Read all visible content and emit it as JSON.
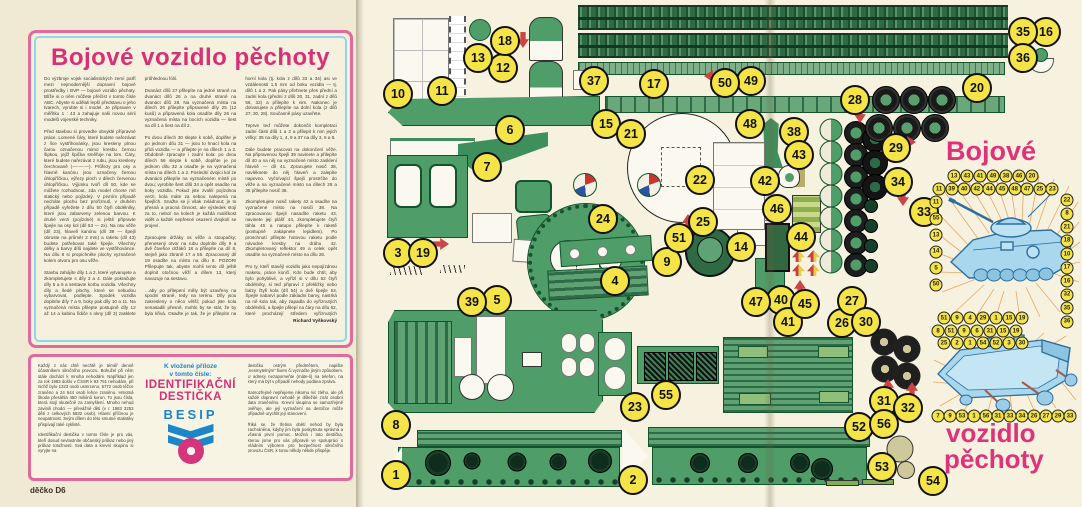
{
  "magazine": {
    "left_page": {
      "title": "Bojové vozidlo pěchoty",
      "article_text": "Do výzbroje vojsk socialistických zemí patří mezi nejmodernější dopravní bojové prostředky i BVP — bojové vozidlo pěchoty. Blíže si o něm můžete přečíst v tomto čísle ABC. Abyste si udělali lepší představu o jeho tvarech, vyrobte si i model. Je připraven v měřítku 1 : 43 a zahajuje naši novou sérii modelů vojenské techniky.\n\nPřed stavbou si proveďte obvyklé přípravné práce. Lomené čáry, které budete nařezávat z líce vystřihovánky, jsou kresleny plnou čarou označenou mimo kresbu černou šipkou, jejíž špička směřuje na lom. Čáry, které budete nařezávat z rubu, jsou kresleny čerchovaně (—·—·—). Průřezy pro osy a hlavně kanónu jsou označeny černou úhlopříčkou, výřezy ploch v dílech červenou úhlopříčkou. Výjimku tvoří díl 50, kde se můžete rozhodnout, zda model chcete mít statický nebo pojízdný. V prvním případě necháte plochu bez proříznutí, v druhém případě vyřežete z dílu 50 čtyři obdélníky, které jsou zabarveny zelenou barvou. K druhé verzi (pojízdné) si ještě připravte špejle na osy kol (díl 53 — 2x). Na osu věže (díl 23), hlaveň kanónu (díl 39 — špejli obruste na průměr 2 mm) a raketu (díl 43) budete potřebovat také špejle. Všechny délky a barvy dílů najdete ve vystřihovánce. Na dílu 8 si propíchněte plochy vyznačené kolem otvoru pro osu věže.\n\nStavbu zahájíte díly 1 a 2, které vytvarujete a zkompletujete s díly 3 a 4. Dále pokračujte díly 5 a 6 a sestavte korbu vozidla. Všechny díly a šedé plochy, které se nebudou vybarvovat, podlepte. Spodek vozidla doplníte díly 7 a 9, boky pak díly 10 a 11. Na vyznačená místa přilepte postupně díly 12 až 14 a kabinu řidiče s okny (díl 3) zasklete průhlednou fólií.\n\nDvanáct dílů 27 přilepíte na jedné straně na dvanáct dílů 26 a na druhé straně na dvanáct dílů 28. Na vyznačená místa na dílech 26 přilepíte připravené díly 25 (12 kusů) a připravená kola osadíte díly 26 na vyznačená místa na bocích vozidla — šest na díl 1 a šest na díl 2.\n\nPo dvou dílech 30 slepte k sobě, doplňte je po jednom dílu 31 — jsou to hnací kola na přídi vozidla — a přilepte je na dílech 1 a 2. Obdobně zpracujte i zadní kola: po dvou dílech 56 slepte k sobě, doplňte je po jednom dílu 32 a osaďte je na vyznačená místa na dílech 1 a 2. Poslední dvojici kol ze dvanácti přilepíte na vyznačeném místě po dvou; vyrobíte šest dílů 34 a opět osadíte na boky vozidla. Pokud jste zvolili pojízdnou verzi, kola máte za sebou nalepená na špejlích. Snažte se ji však zvládnout; je to přesná a pracná činnost, ale výsledek stojí za to, neboť na kolech je každá maličkost vidět a každé nepřesné osazení dvojkolí se projeví.\n\nZpracujete držáky os věže a stoupačky; přenesený otvor na rubu doplníte díly 9 a dvě čtveřice držáků 18 a přilepíte na díl 8, stejně jako zbraně 17 a 55. Zpracovaný díl 19 osadíte na místo na dílu 8. POZOR! Přilepujte tak, abyste mohli tento díl ještě doplnit otočnou věží a dílem 13, který navazuje na sestavu.\n\n…aby po přilepení měly být uzavřeny na spodní straně, tedy na terénu. Díly jsou zakresleny o něco větší; pokud jste kola nenasadili přesně, mohlo by se stát, že by byla křivá. Osaďte je tak, že je přilepíte na horní kola (tj. kola z dílů 33 a 34) asi ve vzdálenosti 1,5 mm od boku vozidla — tj. dílů 1 a 2. Pak pásy přehnete přes přední a zadní kola (přední z dílů 30, 31, zadní z dílů 56, 32) a přilepíte k nim. Nakonec je dotvarujete a přilepíte na dolní kola (z dílů 27, 30, 28). Současně pásy uzavřete.\n\nTeprve teď můžete dokončit kompletaci zadní části dílů 1 a 2 a přilepit k nim jejich vršky: 35 na díly 1, 4, 9 a 37 na díly 3, 6 a 8.\n\nDále budete pracovat na dokončení věže. Na připravenou špejli 39 navinete a přilepíte díl 40 a na něj na vyznačené místo zasklení hlavně — díl 41. Zpracujete nosič 38, navléknete do něj hlaveň a zalepíte napevno. Vyčnívající špejli prostrčíte do věže a na vyznačené místo na dílech 28 a 35 přilepíte nosič 38.\n\nZkompletujete nosič rakety 42 a osadíte na vyznačené místo na nosiči 38. Na zpracovanou špejli nasadíte raketu 43, navinete její plášť 44, zkompletujete čtyři táhla 45 a natupo přilepíte k raketě (postupně zakápnete lepidlem). Po proschnutí přilepte hotovou raketu podle návodné kresby na dráhu 42. Zkompletovaný reflektor 49 a celek opět osadíte na vyznačené místo na dílu 26.\n\nPro ty, kteří stavějí vozidlo jako nepojízdnou maketu, práce končí. Kdo bude chtít, aby bylo pohyblivé, a vyřízl si v dílu 52 čtyři obdélníky, si teď připraví z překližky nebo balzy čtyři kola (díl 54) a dvě špejle 53. Špejle nabarví podle základní barvy, nastrká na ně kola tak, aby zapadla do vyříznutých obdélníků, a špejle přilepí na čáry na dílu 52, které procházejí středem vyříznutých obdélníků.\n\nPoslední prací je nalakování nebo nastříkání vozidla bezbarvým lakem, který zpevní celou konstrukci a dá barvám kovový lesk.\n\nVěříme, že jste pracovali přesně a že jste s výsledkem naší i vlastní práce spokojeni. Na shledanou u dalších vystřihovánek se těší",
      "signature": "Richard Vyškovský",
      "footer": "děčko D6",
      "insert_box": {
        "left_text": "Každý z nás chtě nechtě je téměř denně účastníkem silničního provozu. Bohužel při něm stále dochází k mnoha nehodám. Například jen za rok 1983 došlo v ČSSR k 93 751 nehodám, při nichž bylo 1323 osob usmrceno, 5772 osob těžce zraněno a 24 644 osob lehce zraněno. Hmotná škoda přesáhla 450 miliónů korun. To jsou čísla, která stojí skutečně za zamyšlení. Mnoho nehod zavinili chodci — převážně děti (v r. 1983 3253 dětí z celkových 5832 osob). Hlavní příčinou je neopatrnost. Svým dílem do této smutné statistiky přispívají také cyklisté.\n\nIdentifikační destička v tomto čísle je pro vás, kteří dosud nevlastníte občanský průkaz nebo jiný průkaz totožnosti. Svá data a krevní skupinu si vyryjte na",
        "heading_line1": "K vložené příloze",
        "heading_line2": "v tomto čísle:",
        "product_line1": "IDENTIFIKAČNÍ",
        "product_line2": "DESTIČKA",
        "brand": "BESIP",
        "right_text": "destičku ostrým předmětem, napište „nesmytelným“ fixem či vyznačte jiným způsobem. U adresy nezapomeňte (máte-li) na telefon, na který má být v případě nehody podána zpráva.\n\nSamozřejmě nepřejeme nikomu nic zlého, ale při každé dopravní nehodě je důležité znát osobní data zraněného. Krevní skupina se samozřejmě ověřuje, ale její vyznačení na destičce může případně urychlit její stanovení.\n\nŘíká se, že třetina obětí nehod by byla zachráněna, kdyby jim byla poskytnuta správná a včasná první pomoc. Možná i tato destička, kterou jsme pro vás připravili ve spolupráci s Vládním výborem pro bezpečnost silničního provozu ČSR, k tomu někdy někde přispěje."
      }
    },
    "right_page": {
      "title_top": "Bojové",
      "title_bottom_line1": "vozidlo",
      "title_bottom_line2": "pěchoty",
      "parts": [
        {
          "n": "1",
          "x": 396,
          "y": 475
        },
        {
          "n": "2",
          "x": 633,
          "y": 480
        },
        {
          "n": "3",
          "x": 398,
          "y": 253
        },
        {
          "n": "4",
          "x": 615,
          "y": 281
        },
        {
          "n": "5",
          "x": 497,
          "y": 300
        },
        {
          "n": "6",
          "x": 510,
          "y": 130
        },
        {
          "n": "7",
          "x": 487,
          "y": 167
        },
        {
          "n": "8",
          "x": 396,
          "y": 425
        },
        {
          "n": "9",
          "x": 667,
          "y": 262
        },
        {
          "n": "10",
          "x": 398,
          "y": 94
        },
        {
          "n": "11",
          "x": 442,
          "y": 91
        },
        {
          "n": "12",
          "x": 503,
          "y": 68
        },
        {
          "n": "13",
          "x": 478,
          "y": 58
        },
        {
          "n": "14",
          "x": 741,
          "y": 247
        },
        {
          "n": "15",
          "x": 606,
          "y": 124
        },
        {
          "n": "16",
          "x": 1046,
          "y": 32
        },
        {
          "n": "17",
          "x": 654,
          "y": 84
        },
        {
          "n": "18",
          "x": 505,
          "y": 41
        },
        {
          "n": "19",
          "x": 423,
          "y": 253
        },
        {
          "n": "20",
          "x": 977,
          "y": 88
        },
        {
          "n": "21",
          "x": 631,
          "y": 134
        },
        {
          "n": "22",
          "x": 700,
          "y": 180
        },
        {
          "n": "23",
          "x": 635,
          "y": 407
        },
        {
          "n": "24",
          "x": 603,
          "y": 219
        },
        {
          "n": "25",
          "x": 703,
          "y": 222
        },
        {
          "n": "26",
          "x": 842,
          "y": 323
        },
        {
          "n": "27",
          "x": 852,
          "y": 301
        },
        {
          "n": "28",
          "x": 855,
          "y": 100
        },
        {
          "n": "29",
          "x": 896,
          "y": 148
        },
        {
          "n": "30",
          "x": 866,
          "y": 322
        },
        {
          "n": "31",
          "x": 884,
          "y": 401
        },
        {
          "n": "32",
          "x": 908,
          "y": 408
        },
        {
          "n": "33",
          "x": 924,
          "y": 212
        },
        {
          "n": "34",
          "x": 898,
          "y": 182
        },
        {
          "n": "35",
          "x": 1023,
          "y": 32
        },
        {
          "n": "36",
          "x": 1023,
          "y": 58
        },
        {
          "n": "37",
          "x": 594,
          "y": 81
        },
        {
          "n": "38",
          "x": 794,
          "y": 132
        },
        {
          "n": "39",
          "x": 472,
          "y": 302
        },
        {
          "n": "40",
          "x": 781,
          "y": 300
        },
        {
          "n": "41",
          "x": 788,
          "y": 322
        },
        {
          "n": "42",
          "x": 765,
          "y": 181
        },
        {
          "n": "43",
          "x": 799,
          "y": 155
        },
        {
          "n": "44",
          "x": 801,
          "y": 237
        },
        {
          "n": "45",
          "x": 805,
          "y": 304
        },
        {
          "n": "46",
          "x": 777,
          "y": 209
        },
        {
          "n": "47",
          "x": 756,
          "y": 302
        },
        {
          "n": "48",
          "x": 750,
          "y": 124
        },
        {
          "n": "49",
          "x": 751,
          "y": 81
        },
        {
          "n": "50",
          "x": 725,
          "y": 83
        },
        {
          "n": "51",
          "x": 679,
          "y": 238
        },
        {
          "n": "52",
          "x": 859,
          "y": 427
        },
        {
          "n": "53",
          "x": 882,
          "y": 467
        },
        {
          "n": "54",
          "x": 933,
          "y": 481
        },
        {
          "n": "55",
          "x": 666,
          "y": 395
        },
        {
          "n": "56",
          "x": 884,
          "y": 424
        }
      ],
      "callouts": {
        "t1": [
          "13",
          "43",
          "41",
          "49",
          "38",
          "46",
          "20"
        ],
        "t2": [
          "11",
          "39",
          "40",
          "42",
          "44",
          "45",
          "48",
          "47",
          "25",
          "23"
        ],
        "lc": [
          "11",
          "55",
          "13",
          "14",
          "5",
          "50"
        ],
        "rc": [
          "22",
          "8",
          "21",
          "18",
          "10",
          "17",
          "16",
          "32",
          "35",
          "36"
        ],
        "b1": [
          "51",
          "9",
          "4",
          "29",
          "1",
          "15",
          "19"
        ],
        "c1": [
          "8",
          "51",
          "9",
          "6",
          "31",
          "15",
          "19"
        ],
        "c2": [
          "25",
          "2",
          "1",
          "54",
          "52",
          "3",
          "30"
        ],
        "b2": [
          "7",
          "9",
          "53",
          "1",
          "56",
          "31",
          "33",
          "34",
          "26",
          "27",
          "29",
          "33"
        ]
      }
    },
    "colors": {
      "magenta": "#d92f75",
      "blue": "#1b86c9",
      "cyan_border": "#8fd8e8",
      "part_green": "#4f9d68",
      "circle_yellow": "#f4e448",
      "illustration_blue": "#a9d7ee"
    }
  }
}
